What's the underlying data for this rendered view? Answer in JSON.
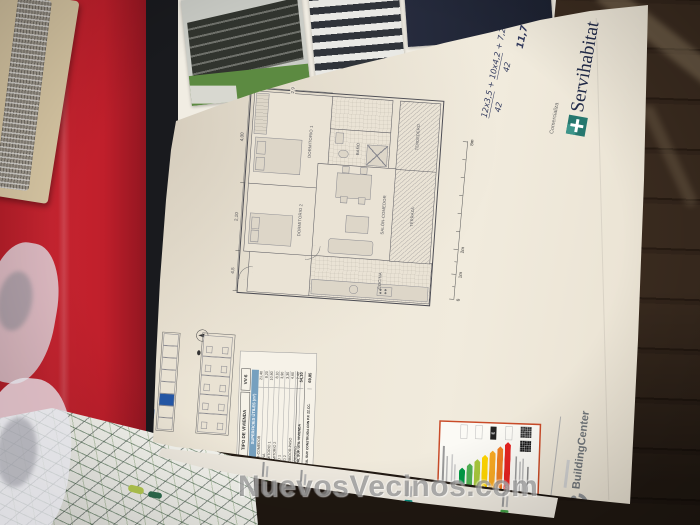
{
  "watermark": {
    "text": "NuevosVecinos.com"
  },
  "branding": {
    "comercializa": "Comercializa",
    "servihabitat": "Servihabitat",
    "buildingcenter": "BuildingCenter"
  },
  "handwriting": {
    "num1": "12x3,5",
    "den1": "42",
    "plus1": "+",
    "num2": "10x4,2",
    "den2": "42",
    "plus2": "+",
    "num3": "7,2x1,5",
    "result": "11,7"
  },
  "floor_plan": {
    "rooms": [
      "DORMITORIO 1",
      "DORMITORIO 2",
      "BAÑO",
      "COCINA",
      "SALÓN-COMEDOR",
      "TERRAZA",
      "TENDEDERO"
    ],
    "dimensions": [
      "4,5",
      "2,10",
      "4,00",
      "2,9"
    ],
    "scale_labels": [
      "0",
      "1m",
      "2m",
      "8m"
    ]
  },
  "unit_table": {
    "type_label": "TIPO DE VIVIENDA",
    "unit_code": "VV-6",
    "header": "SUPERFICIES ÚTILES (m²)",
    "rows": [
      {
        "label": "ESTAR-COMEDOR",
        "value": "21,40"
      },
      {
        "label": "COCINA",
        "value": "8,20"
      },
      {
        "label": "DORMITORIO 1",
        "value": "10,60"
      },
      {
        "label": "DORMITORIO 2",
        "value": "8,10"
      },
      {
        "label": "BAÑO 1",
        "value": "3,90"
      },
      {
        "label": "BAÑO 2",
        "value": "3,30"
      },
      {
        "label": "RECIBIDOR-PASO",
        "value": "4,60"
      },
      {
        "label": "TENDEDERO",
        "value": "2,40"
      }
    ],
    "totals": [
      {
        "label": "TOTAL SUP. ÚTIL VIVIENDA",
        "value": "54,10"
      },
      {
        "label": "TOTAL SUP. CONSTRUIDA CON P.P. ZZ.CC.",
        "value": "69,85"
      }
    ]
  },
  "energy_label": {
    "ratings": [
      "A",
      "B",
      "C",
      "D",
      "E",
      "F",
      "G"
    ],
    "colors": [
      "#009a44",
      "#52b153",
      "#a8c83c",
      "#ffd500",
      "#f7a823",
      "#ef7d23",
      "#e52321"
    ],
    "border_color": "#c94b28"
  }
}
